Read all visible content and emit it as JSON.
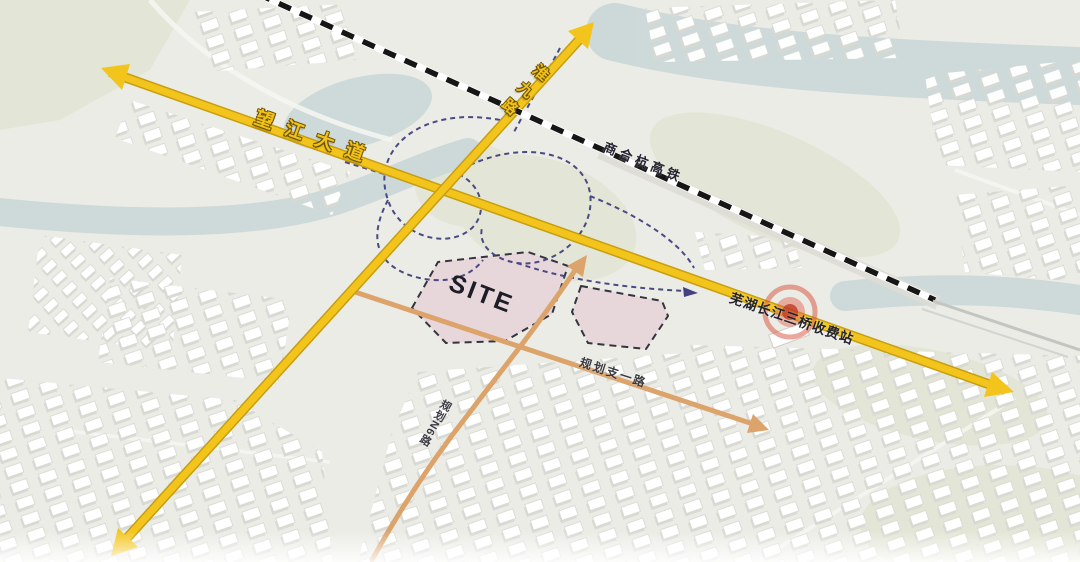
{
  "map": {
    "kind": "urban-planning-site-map",
    "labels": {
      "avenue": "望江大道",
      "north_south_road": "淮九路",
      "railway": "商合杭高铁",
      "toll_station": "芜湖长江三桥收费站",
      "planned_branch_road": "规划支一路",
      "planned_n6_road": "规划N6路",
      "site": "SITE"
    },
    "colors": {
      "main_road_yellow": "#F3C51C",
      "planned_road_orange": "#DCA36B",
      "ramp_blue": "#42427E",
      "railway_black": "#161616",
      "site_fill_pink": "#E7D7DA",
      "toll_marker_red": "#D8503A",
      "water": "#CCD8D9",
      "land": "#EBECE6"
    }
  }
}
